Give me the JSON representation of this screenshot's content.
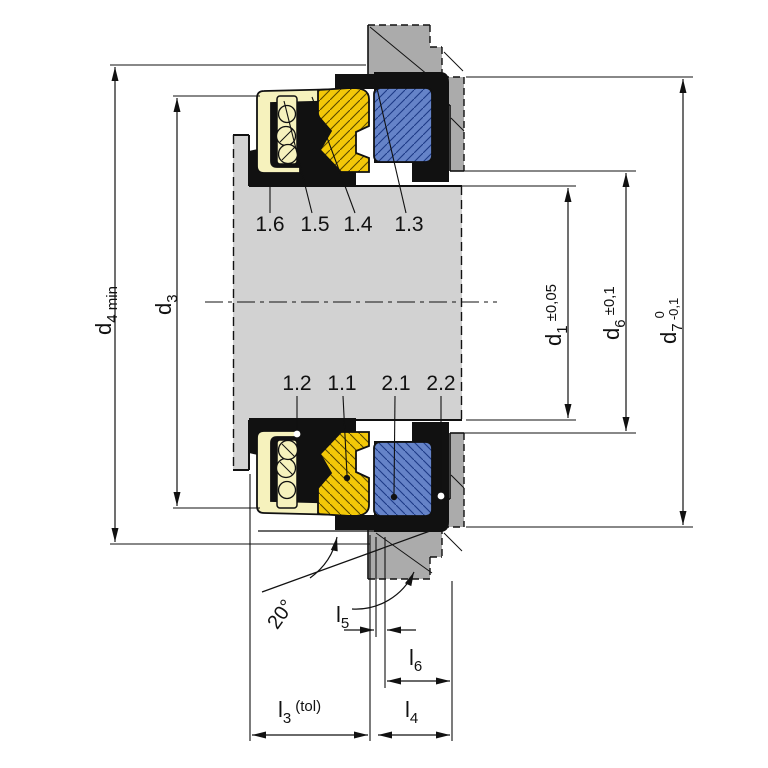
{
  "diagram": {
    "type": "mechanical-seal-cross-section",
    "part_labels": {
      "top": [
        "1.6",
        "1.5",
        "1.4",
        "1.3"
      ],
      "bottom": [
        "1.2",
        "1.1",
        "2.1",
        "2.2"
      ]
    },
    "diameter_dims": {
      "d4": {
        "symbol": "d",
        "sub": "4 min"
      },
      "d3": {
        "symbol": "d",
        "sub": "3"
      },
      "d1": {
        "symbol": "d",
        "sub": "1",
        "tol": "±0,05"
      },
      "d6": {
        "symbol": "d",
        "sub": "6",
        "tol": "±0,1"
      },
      "d7": {
        "symbol": "d",
        "sub": "7",
        "tol_upper": "0",
        "tol_lower": "-0,1"
      }
    },
    "length_dims": {
      "l3": {
        "symbol": "l",
        "sub": "3",
        "suffix": "(tol)"
      },
      "l4": {
        "symbol": "l",
        "sub": "4"
      },
      "l5": {
        "symbol": "l",
        "sub": "5"
      },
      "l6": {
        "symbol": "l",
        "sub": "6"
      }
    },
    "angle_label": "20°",
    "colors": {
      "face_ring": "#f3c808",
      "seat_ring": "#6583c8",
      "elastomer": "#111111",
      "metal_shell": "#f6f2bd",
      "shaft": "#d2d2d2",
      "housing": "#ababab"
    }
  }
}
